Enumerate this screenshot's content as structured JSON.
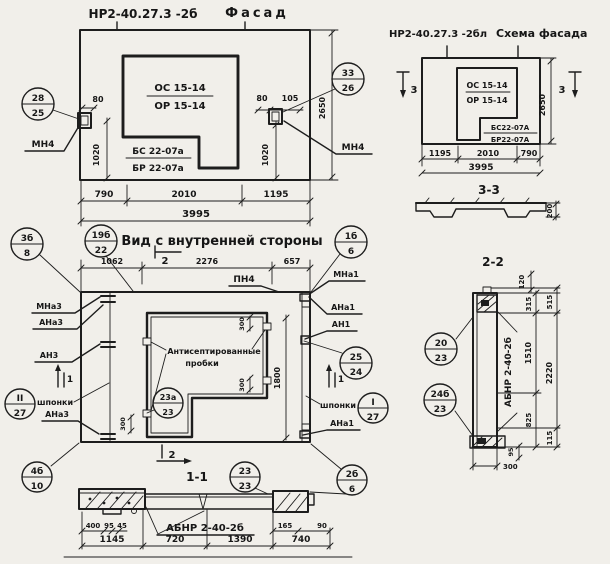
{
  "colors": {
    "paper": "#f1efea",
    "ink": "#1d1d1d"
  },
  "facade": {
    "code": "НР2-40.27.3 -2б",
    "name": "Фасад",
    "win_top": "ОС 15-14",
    "win_bot": "ОР 15-14",
    "sill_top": "БС 22-07а",
    "sill_bot": "БР 22-07а",
    "anchor_left": "МН4",
    "anchor_right": "МН4",
    "co_left_num": "28",
    "co_left_den": "25",
    "co_right_num": "33",
    "co_right_den": "26",
    "d80l": "80",
    "d1020l": "1020",
    "d80r": "80",
    "d105": "105",
    "d1020r": "1020",
    "d2650": "2650",
    "d790": "790",
    "d2010": "2010",
    "d1195": "1195",
    "d3995": "3995"
  },
  "schema": {
    "code": "НР2-40.27.3 -2бл",
    "name": "Схема фасада",
    "win_top": "ОС 15-14",
    "win_bot": "ОР 15-14",
    "sill_top": "БС22-07А",
    "sill_bot": "БР22-07А",
    "mark": "3",
    "d2650": "2650",
    "d1195": "1195",
    "d2010": "2010",
    "d790": "790",
    "d3995": "3995",
    "sec_label": "3-3",
    "d200": "200"
  },
  "inner": {
    "title": "Вид с внутренней стороны",
    "pn4": "ПН4",
    "mna3": "МНа3",
    "ana3": "АНа3",
    "an3": "АН3",
    "shponki": "шпонки",
    "mna1": "МНа1",
    "ana1": "АНа1",
    "an1": "АН1",
    "note1": "Антисептированные",
    "note2": "пробки",
    "mark1": "1",
    "mark2": "2",
    "d1062": "1062",
    "d2276": "2276",
    "d657": "657",
    "d1800": "1800",
    "d300": "300",
    "co_3b8_num": "3б",
    "co_3b8_den": "8",
    "co_19b22_num": "19б",
    "co_19b22_den": "22",
    "co_1b6_num": "1б",
    "co_1b6_den": "6",
    "co_II27_num": "II",
    "co_II27_den": "27",
    "co_I27_num": "I",
    "co_I27_den": "27",
    "co_23a23_num": "23а",
    "co_23a23_den": "23",
    "co_2524_num": "25",
    "co_2524_den": "24",
    "co_2b6_num": "2б",
    "co_2b6_den": "6",
    "co_4b10_num": "4б",
    "co_4b10_den": "10"
  },
  "sec11": {
    "label": "1-1",
    "code": "АБНР 2-40-2б",
    "co_num": "23",
    "co_den": "23",
    "d400": "400",
    "d95": "95",
    "d45": "45",
    "d165": "165",
    "d90": "90",
    "d1145": "1145",
    "d720": "720",
    "d1390": "1390",
    "d740": "740"
  },
  "sec22": {
    "label": "2-2",
    "code": "АБНР 2-40-2б",
    "co_top_num": "20",
    "co_top_den": "23",
    "co_bot_num": "24б",
    "co_bot_den": "23",
    "d120": "120",
    "d315": "315",
    "d515": "515",
    "d1510": "1510",
    "d2220": "2220",
    "d825": "825",
    "d115": "115",
    "d95": "95",
    "d300": "300"
  }
}
